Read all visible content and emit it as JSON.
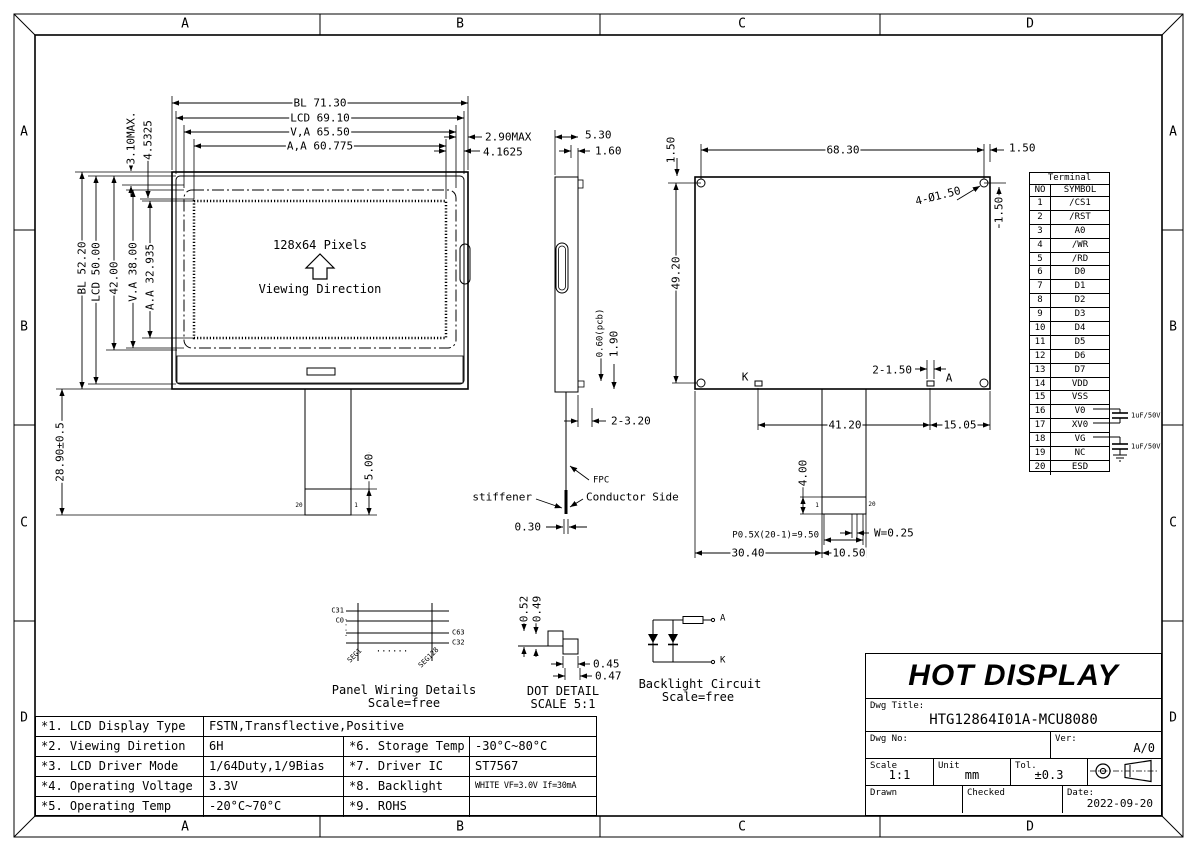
{
  "colors": {
    "ink": "#000000",
    "paper": "#ffffff"
  },
  "zones": {
    "cols": [
      "A",
      "B",
      "C",
      "D"
    ],
    "rows": [
      "A",
      "B",
      "C",
      "D"
    ]
  },
  "front": {
    "dim_bl_w": "BL 71.30",
    "dim_lcd_w": "LCD 69.10",
    "dim_va_w": "V,A 65.50",
    "dim_aa_w": "A,A 60.775",
    "dim_bezel": "2.90MAX",
    "dim_border": "4.1625",
    "dim_top1": "3.10MAX.",
    "dim_top2": "4.5325",
    "dim_bl_h": "BL 52.20",
    "dim_lcd_h": "LCD 50.00",
    "dim_pcb_h": "42.00",
    "dim_va_h": "V.A 38.00",
    "dim_aa_h": "A.A 32.935",
    "dim_tail": "28.90±0.5",
    "dim_stiff": "5.00",
    "pixels": "128x64 Pixels",
    "viewing": "Viewing Direction",
    "pin_left": "20",
    "pin_right": "1"
  },
  "side": {
    "dim_w": "5.30",
    "dim_tab": "1.60",
    "dim_pcb": "0.60(pcb)",
    "dim_bump": "1.90",
    "dim_bottom": "2-3.20",
    "dim_fpc_thk": "0.30",
    "lbl_fpc": "FPC",
    "lbl_stiffener": "stiffener",
    "lbl_conductor": "Conductor Side"
  },
  "rear": {
    "dim_hole_top": "1.50",
    "dim_w": "68.30",
    "dim_hole_right": "1.50",
    "dim_hole_right_v": "1.50",
    "lbl_holes": "4-Ø1.50",
    "dim_h": "49.20",
    "lbl_k": "K",
    "lbl_a": "A",
    "dim_pads": "2-1.50",
    "dim_span": "41.20",
    "dim_right": "15.05",
    "dim_conn_h": "4.00",
    "dim_pitch": "P0.5X(20-1)=9.50",
    "dim_pin_w": "W=0.25",
    "dim_left": "30.40",
    "dim_conn_w": "10.50",
    "pin_first": "1",
    "pin_last": "20"
  },
  "terminal": {
    "title": "Terminal",
    "col_no": "NO",
    "col_symbol": "SYMBOL",
    "rows": [
      {
        "no": "1",
        "symbol": "/CS1"
      },
      {
        "no": "2",
        "symbol": "/RST"
      },
      {
        "no": "3",
        "symbol": "A0"
      },
      {
        "no": "4",
        "symbol": "/WR"
      },
      {
        "no": "5",
        "symbol": "/RD"
      },
      {
        "no": "6",
        "symbol": "D0"
      },
      {
        "no": "7",
        "symbol": "D1"
      },
      {
        "no": "8",
        "symbol": "D2"
      },
      {
        "no": "9",
        "symbol": "D3"
      },
      {
        "no": "10",
        "symbol": "D4"
      },
      {
        "no": "11",
        "symbol": "D5"
      },
      {
        "no": "12",
        "symbol": "D6"
      },
      {
        "no": "13",
        "symbol": "D7"
      },
      {
        "no": "14",
        "symbol": "VDD"
      },
      {
        "no": "15",
        "symbol": "VSS"
      },
      {
        "no": "16",
        "symbol": "V0"
      },
      {
        "no": "17",
        "symbol": "XV0"
      },
      {
        "no": "18",
        "symbol": "VG"
      },
      {
        "no": "19",
        "symbol": "NC"
      },
      {
        "no": "20",
        "symbol": "ESD"
      }
    ],
    "cap1": "1uF/50V",
    "cap2": "1uF/50V"
  },
  "wiring": {
    "c31": "C31",
    "c0": "C0",
    "c63": "C63",
    "c32": "C32",
    "seg1": "SEG1",
    "seg128": "SEG128",
    "dots": "......",
    "vdots": "....",
    "caption": "Panel Wiring Details",
    "scale": "Scale=free"
  },
  "dot_detail": {
    "d1": "0.52",
    "d2": "0.49",
    "d3": "0.45",
    "d4": "0.47",
    "caption": "DOT DETAIL",
    "scale": "SCALE 5:1"
  },
  "backlight": {
    "anode": "A",
    "cathode": "K",
    "caption": "Backlight Circuit",
    "scale": "Scale=free"
  },
  "title_block": {
    "company": "HOT DISPLAY",
    "dwg_title_label": "Dwg Title:",
    "dwg_title": "HTG12864I01A-MCU8080",
    "dwg_no_label": "Dwg No:",
    "ver_label": "Ver:",
    "ver": "A/0",
    "scale_label": "Scale",
    "scale": "1:1",
    "unit_label": "Unit",
    "unit": "mm",
    "tol_label": "Tol.",
    "tol": "±0.3",
    "drawn_label": "Drawn",
    "checked_label": "Checked",
    "date_label": "Date:",
    "date": "2022-09-20"
  },
  "spec": {
    "rows": [
      {
        "label": "*1. LCD Display Type",
        "value": "FSTN,Transflective,Positive"
      },
      {
        "label": "*2. Viewing Diretion",
        "value": "6H",
        "label2": "*6. Storage Temp",
        "value2": "-30°C~80°C"
      },
      {
        "label": "*3. LCD Driver Mode",
        "value": "1/64Duty,1/9Bias",
        "label2": "*7. Driver IC",
        "value2": "ST7567"
      },
      {
        "label": "*4. Operating Voltage",
        "value": "3.3V",
        "label2": "*8. Backlight",
        "value2": "WHITE VF=3.0V If=30mA"
      },
      {
        "label": "*5. Operating Temp",
        "value": "-20°C~70°C",
        "label2": "*9. ROHS",
        "value2": ""
      }
    ]
  }
}
